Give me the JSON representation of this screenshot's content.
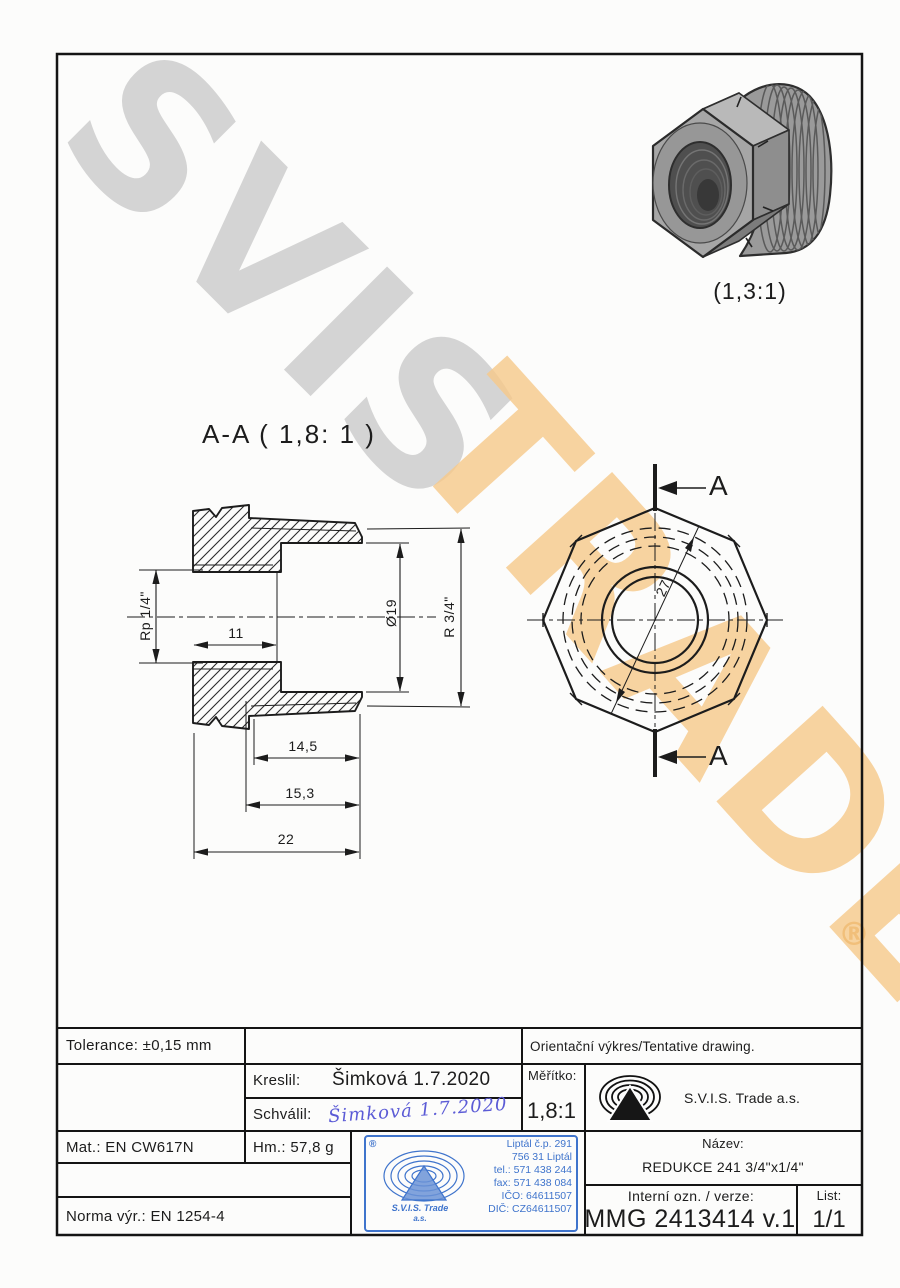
{
  "watermarks": {
    "brand_top": "SVIS",
    "brand_bottom": "TRADE",
    "registered": "®",
    "gray": "#cbcbcb",
    "orange": "#f7c98a"
  },
  "views": {
    "section_label": "A-A ( 1,8: 1 )",
    "iso_label": "(1,3:1)",
    "section_arrow_label": "A",
    "dims": {
      "rp": "Rp 1/4\"",
      "thread_len": "11",
      "dia19": "Ø19",
      "r34": "R 3/4\"",
      "len145": "14,5",
      "len153": "15,3",
      "len22": "22",
      "across27": "27"
    }
  },
  "titleblock": {
    "tolerance": "Tolerance: ±0,15 mm",
    "orientacni": "Orientační výkres/Tentative drawing.",
    "kreslil_label": "Kreslil:",
    "kreslil_value": "Šimková 1.7.2020",
    "schvalil_label": "Schválil:",
    "schvalil_signature": "Šimková  1.7.2020",
    "meritko_label": "Měřítko:",
    "meritko_value": "1,8:1",
    "company": "S.V.I.S. Trade a.s.",
    "mat": "Mat.: EN CW617N",
    "hm": "Hm.: 57,8 g",
    "norma": "Norma výr.: EN 1254-4",
    "nazev_label": "Název:",
    "nazev_value": "REDUKCE 241 3/4\"x1/4\"",
    "interni_label": "Interní ozn. / verze:",
    "interni_value": "MMG 2413414 v.1",
    "list_label": "List:",
    "list_value": "1/1",
    "stamp": {
      "registered": "®",
      "lines": [
        "Liptál č.p. 291",
        "756 31 Liptál",
        "tel.: 571 438 244",
        "fax: 571 438 084",
        "IČO: 64611507",
        "DIČ: CZ64611507"
      ],
      "company1": "S.V.I.S. Trade",
      "company2": "a.s.",
      "blue": "#3f74cc"
    },
    "signature_ink": "#5b5bd6"
  }
}
